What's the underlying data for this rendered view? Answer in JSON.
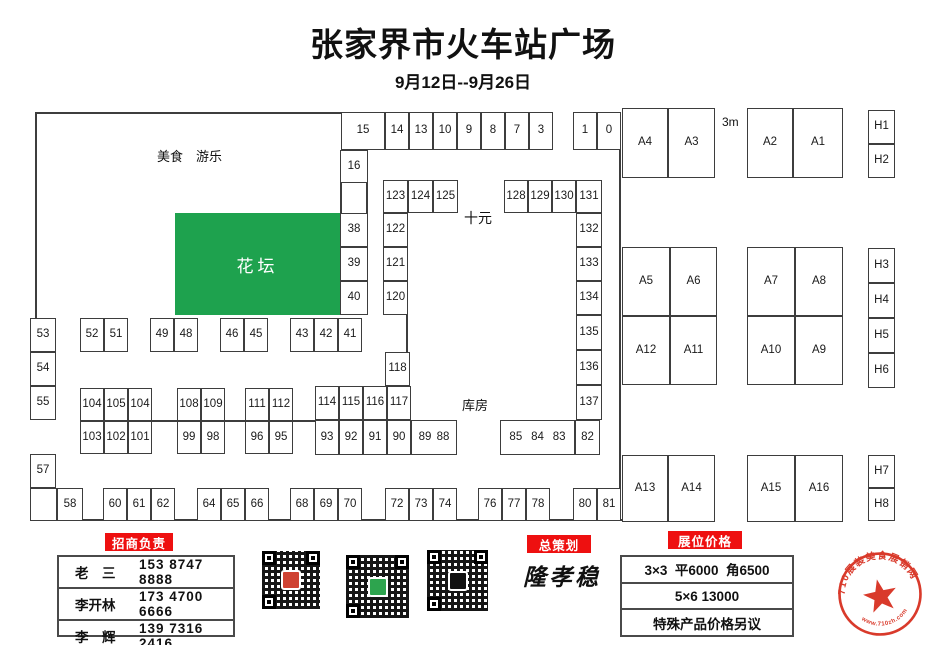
{
  "title": "张家界市火车站广场",
  "subtitle": "9月12日--9月26日",
  "colors": {
    "flowerbed_green": "#1ea24e",
    "badge_red": "#ee1010",
    "stamp_red": "#d93a2b"
  },
  "plan": {
    "flowerbed_label": "花坛",
    "texts": [
      {
        "n": "food-amusement-label",
        "t": "美食　游乐",
        "x": 157,
        "y": 150,
        "fs": 13
      },
      {
        "n": "ten-yuan-label",
        "t": "十元",
        "x": 464,
        "y": 211,
        "fs": 14
      },
      {
        "n": "warehouse-label",
        "t": "库房",
        "x": 462,
        "y": 399,
        "fs": 13
      },
      {
        "n": "scale-3m-label",
        "t": "3m",
        "x": 722,
        "y": 116,
        "fs": 12
      }
    ],
    "cells": [
      {
        "l": "15",
        "x": 341,
        "y": 112,
        "w": 44,
        "h": 38
      },
      {
        "l": "14",
        "x": 385,
        "y": 112,
        "w": 24,
        "h": 38
      },
      {
        "l": "13",
        "x": 409,
        "y": 112,
        "w": 24,
        "h": 38
      },
      {
        "l": "10",
        "x": 433,
        "y": 112,
        "w": 24,
        "h": 38
      },
      {
        "l": "9",
        "x": 457,
        "y": 112,
        "w": 24,
        "h": 38
      },
      {
        "l": "8",
        "x": 481,
        "y": 112,
        "w": 24,
        "h": 38
      },
      {
        "l": "7",
        "x": 505,
        "y": 112,
        "w": 24,
        "h": 38
      },
      {
        "l": "3",
        "x": 529,
        "y": 112,
        "w": 24,
        "h": 38
      },
      {
        "l": "1",
        "x": 573,
        "y": 112,
        "w": 24,
        "h": 38
      },
      {
        "l": "0",
        "x": 597,
        "y": 112,
        "w": 24,
        "h": 38
      },
      {
        "l": "16",
        "x": 340,
        "y": 150,
        "w": 28,
        "h": 33
      },
      {
        "l": "38",
        "x": 340,
        "y": 213,
        "w": 28,
        "h": 34
      },
      {
        "l": "39",
        "x": 340,
        "y": 247,
        "w": 28,
        "h": 34
      },
      {
        "l": "40",
        "x": 340,
        "y": 281,
        "w": 28,
        "h": 34
      },
      {
        "l": "123",
        "x": 383,
        "y": 180,
        "w": 25,
        "h": 33
      },
      {
        "l": "124",
        "x": 408,
        "y": 180,
        "w": 25,
        "h": 33
      },
      {
        "l": "125",
        "x": 433,
        "y": 180,
        "w": 25,
        "h": 33
      },
      {
        "l": "122",
        "x": 383,
        "y": 213,
        "w": 25,
        "h": 34
      },
      {
        "l": "121",
        "x": 383,
        "y": 247,
        "w": 25,
        "h": 34
      },
      {
        "l": "120",
        "x": 383,
        "y": 281,
        "w": 25,
        "h": 34
      },
      {
        "l": "118",
        "x": 385,
        "y": 352,
        "w": 25,
        "h": 34
      },
      {
        "l": "128",
        "x": 504,
        "y": 180,
        "w": 24,
        "h": 33
      },
      {
        "l": "129",
        "x": 528,
        "y": 180,
        "w": 24,
        "h": 33
      },
      {
        "l": "130",
        "x": 552,
        "y": 180,
        "w": 24,
        "h": 33
      },
      {
        "l": "131",
        "x": 576,
        "y": 180,
        "w": 26,
        "h": 33
      },
      {
        "l": "132",
        "x": 576,
        "y": 213,
        "w": 26,
        "h": 34
      },
      {
        "l": "133",
        "x": 576,
        "y": 247,
        "w": 26,
        "h": 34
      },
      {
        "l": "134",
        "x": 576,
        "y": 281,
        "w": 26,
        "h": 34
      },
      {
        "l": "135",
        "x": 576,
        "y": 315,
        "w": 26,
        "h": 35
      },
      {
        "l": "136",
        "x": 576,
        "y": 350,
        "w": 26,
        "h": 35
      },
      {
        "l": "137",
        "x": 576,
        "y": 385,
        "w": 26,
        "h": 35
      },
      {
        "l": "82",
        "x": 575,
        "y": 420,
        "w": 25,
        "h": 35
      },
      {
        "l": "85|84|83",
        "x": 500,
        "y": 420,
        "w": 75,
        "h": 35
      },
      {
        "l": "114",
        "x": 315,
        "y": 386,
        "w": 24,
        "h": 34
      },
      {
        "l": "115",
        "x": 339,
        "y": 386,
        "w": 24,
        "h": 34
      },
      {
        "l": "116",
        "x": 363,
        "y": 386,
        "w": 24,
        "h": 34
      },
      {
        "l": "117",
        "x": 387,
        "y": 386,
        "w": 24,
        "h": 34
      },
      {
        "l": "93",
        "x": 315,
        "y": 420,
        "w": 24,
        "h": 35
      },
      {
        "l": "92",
        "x": 339,
        "y": 420,
        "w": 24,
        "h": 35
      },
      {
        "l": "91",
        "x": 363,
        "y": 420,
        "w": 24,
        "h": 35
      },
      {
        "l": "90",
        "x": 387,
        "y": 420,
        "w": 24,
        "h": 35
      },
      {
        "l": "89|88",
        "x": 411,
        "y": 420,
        "w": 46,
        "h": 35
      },
      {
        "l": "104",
        "x": 80,
        "y": 388,
        "w": 24,
        "h": 33
      },
      {
        "l": "105",
        "x": 104,
        "y": 388,
        "w": 24,
        "h": 33
      },
      {
        "l": "104",
        "x": 128,
        "y": 388,
        "w": 24,
        "h": 33
      },
      {
        "l": "103",
        "x": 80,
        "y": 421,
        "w": 24,
        "h": 33
      },
      {
        "l": "102",
        "x": 104,
        "y": 421,
        "w": 24,
        "h": 33
      },
      {
        "l": "101",
        "x": 128,
        "y": 421,
        "w": 24,
        "h": 33
      },
      {
        "l": "108",
        "x": 177,
        "y": 388,
        "w": 24,
        "h": 33
      },
      {
        "l": "109",
        "x": 201,
        "y": 388,
        "w": 24,
        "h": 33
      },
      {
        "l": "99",
        "x": 177,
        "y": 421,
        "w": 24,
        "h": 33
      },
      {
        "l": "98",
        "x": 201,
        "y": 421,
        "w": 24,
        "h": 33
      },
      {
        "l": "111",
        "x": 245,
        "y": 388,
        "w": 24,
        "h": 33
      },
      {
        "l": "112",
        "x": 269,
        "y": 388,
        "w": 24,
        "h": 33
      },
      {
        "l": "96",
        "x": 245,
        "y": 421,
        "w": 24,
        "h": 33
      },
      {
        "l": "95",
        "x": 269,
        "y": 421,
        "w": 24,
        "h": 33
      },
      {
        "l": "53",
        "x": 30,
        "y": 318,
        "w": 26,
        "h": 34
      },
      {
        "l": "54",
        "x": 30,
        "y": 352,
        "w": 26,
        "h": 34
      },
      {
        "l": "55",
        "x": 30,
        "y": 386,
        "w": 26,
        "h": 34
      },
      {
        "l": "57",
        "x": 30,
        "y": 454,
        "w": 26,
        "h": 34
      },
      {
        "l": "",
        "x": 30,
        "y": 488,
        "w": 27,
        "h": 33
      },
      {
        "l": "52",
        "x": 80,
        "y": 318,
        "w": 24,
        "h": 34
      },
      {
        "l": "51",
        "x": 104,
        "y": 318,
        "w": 24,
        "h": 34
      },
      {
        "l": "49",
        "x": 150,
        "y": 318,
        "w": 24,
        "h": 34
      },
      {
        "l": "48",
        "x": 174,
        "y": 318,
        "w": 24,
        "h": 34
      },
      {
        "l": "46",
        "x": 220,
        "y": 318,
        "w": 24,
        "h": 34
      },
      {
        "l": "45",
        "x": 244,
        "y": 318,
        "w": 24,
        "h": 34
      },
      {
        "l": "43",
        "x": 290,
        "y": 318,
        "w": 24,
        "h": 34
      },
      {
        "l": "42",
        "x": 314,
        "y": 318,
        "w": 24,
        "h": 34
      },
      {
        "l": "41",
        "x": 338,
        "y": 318,
        "w": 24,
        "h": 34
      },
      {
        "l": "58",
        "x": 57,
        "y": 488,
        "w": 26,
        "h": 33
      },
      {
        "l": "60",
        "x": 103,
        "y": 488,
        "w": 24,
        "h": 33
      },
      {
        "l": "61",
        "x": 127,
        "y": 488,
        "w": 24,
        "h": 33
      },
      {
        "l": "62",
        "x": 151,
        "y": 488,
        "w": 24,
        "h": 33
      },
      {
        "l": "64",
        "x": 197,
        "y": 488,
        "w": 24,
        "h": 33
      },
      {
        "l": "65",
        "x": 221,
        "y": 488,
        "w": 24,
        "h": 33
      },
      {
        "l": "66",
        "x": 245,
        "y": 488,
        "w": 24,
        "h": 33
      },
      {
        "l": "68",
        "x": 290,
        "y": 488,
        "w": 24,
        "h": 33
      },
      {
        "l": "69",
        "x": 314,
        "y": 488,
        "w": 24,
        "h": 33
      },
      {
        "l": "70",
        "x": 338,
        "y": 488,
        "w": 24,
        "h": 33
      },
      {
        "l": "72",
        "x": 385,
        "y": 488,
        "w": 24,
        "h": 33
      },
      {
        "l": "73",
        "x": 409,
        "y": 488,
        "w": 24,
        "h": 33
      },
      {
        "l": "74",
        "x": 433,
        "y": 488,
        "w": 24,
        "h": 33
      },
      {
        "l": "76",
        "x": 478,
        "y": 488,
        "w": 24,
        "h": 33
      },
      {
        "l": "77",
        "x": 502,
        "y": 488,
        "w": 24,
        "h": 33
      },
      {
        "l": "78",
        "x": 526,
        "y": 488,
        "w": 24,
        "h": 33
      },
      {
        "l": "80",
        "x": 573,
        "y": 488,
        "w": 24,
        "h": 33
      },
      {
        "l": "81",
        "x": 597,
        "y": 488,
        "w": 24,
        "h": 33
      },
      {
        "l": "A4",
        "x": 622,
        "y": 108,
        "w": 46,
        "h": 70
      },
      {
        "l": "A3",
        "x": 668,
        "y": 108,
        "w": 47,
        "h": 70
      },
      {
        "l": "A2",
        "x": 747,
        "y": 108,
        "w": 46,
        "h": 70
      },
      {
        "l": "A1",
        "x": 793,
        "y": 108,
        "w": 50,
        "h": 70
      },
      {
        "l": "A5",
        "x": 622,
        "y": 247,
        "w": 48,
        "h": 69
      },
      {
        "l": "A6",
        "x": 670,
        "y": 247,
        "w": 47,
        "h": 69
      },
      {
        "l": "A12",
        "x": 622,
        "y": 316,
        "w": 48,
        "h": 69
      },
      {
        "l": "A11",
        "x": 670,
        "y": 316,
        "w": 47,
        "h": 69
      },
      {
        "l": "A7",
        "x": 747,
        "y": 247,
        "w": 48,
        "h": 69
      },
      {
        "l": "A8",
        "x": 795,
        "y": 247,
        "w": 48,
        "h": 69
      },
      {
        "l": "A10",
        "x": 747,
        "y": 316,
        "w": 48,
        "h": 69
      },
      {
        "l": "A9",
        "x": 795,
        "y": 316,
        "w": 48,
        "h": 69
      },
      {
        "l": "A13",
        "x": 622,
        "y": 455,
        "w": 46,
        "h": 67
      },
      {
        "l": "A14",
        "x": 668,
        "y": 455,
        "w": 47,
        "h": 67
      },
      {
        "l": "A15",
        "x": 747,
        "y": 455,
        "w": 48,
        "h": 67
      },
      {
        "l": "A16",
        "x": 795,
        "y": 455,
        "w": 48,
        "h": 67
      },
      {
        "l": "H1",
        "x": 868,
        "y": 110,
        "w": 27,
        "h": 34
      },
      {
        "l": "H2",
        "x": 868,
        "y": 144,
        "w": 27,
        "h": 34
      },
      {
        "l": "H3",
        "x": 868,
        "y": 248,
        "w": 27,
        "h": 35
      },
      {
        "l": "H4",
        "x": 868,
        "y": 283,
        "w": 27,
        "h": 35
      },
      {
        "l": "H5",
        "x": 868,
        "y": 318,
        "w": 27,
        "h": 35
      },
      {
        "l": "H6",
        "x": 868,
        "y": 353,
        "w": 27,
        "h": 35
      },
      {
        "l": "H7",
        "x": 868,
        "y": 455,
        "w": 27,
        "h": 33
      },
      {
        "l": "H8",
        "x": 868,
        "y": 488,
        "w": 27,
        "h": 33
      }
    ]
  },
  "bottom": {
    "recruit": {
      "badge": "招商负责",
      "contacts": [
        {
          "name": "老　三",
          "phone": "153 8747 8888"
        },
        {
          "name": "李开林",
          "phone": "173 4700 6666"
        },
        {
          "name": "李　辉",
          "phone": "139 7316 2416"
        }
      ]
    },
    "planner": {
      "badge": "总策划",
      "name": "隆孝稳"
    },
    "price": {
      "badge": "展位价格",
      "rows": [
        "3×3  平6000  角6500",
        "5×6 13000",
        "特殊产品价格另议"
      ]
    },
    "qr_codes": [
      {
        "name": "qr-code-left",
        "x": 262,
        "y": 551,
        "size": 58,
        "logo_color": "#cf4232"
      },
      {
        "name": "qr-code-middle",
        "x": 346,
        "y": 555,
        "size": 63,
        "logo_color": "#2da44e"
      },
      {
        "name": "qr-code-wechat",
        "x": 427,
        "y": 550,
        "size": 61,
        "logo_color": "#111111"
      }
    ],
    "stamp": {
      "top_text": "710展装美食展销网",
      "bottom_text": "www.710zh.com"
    }
  }
}
